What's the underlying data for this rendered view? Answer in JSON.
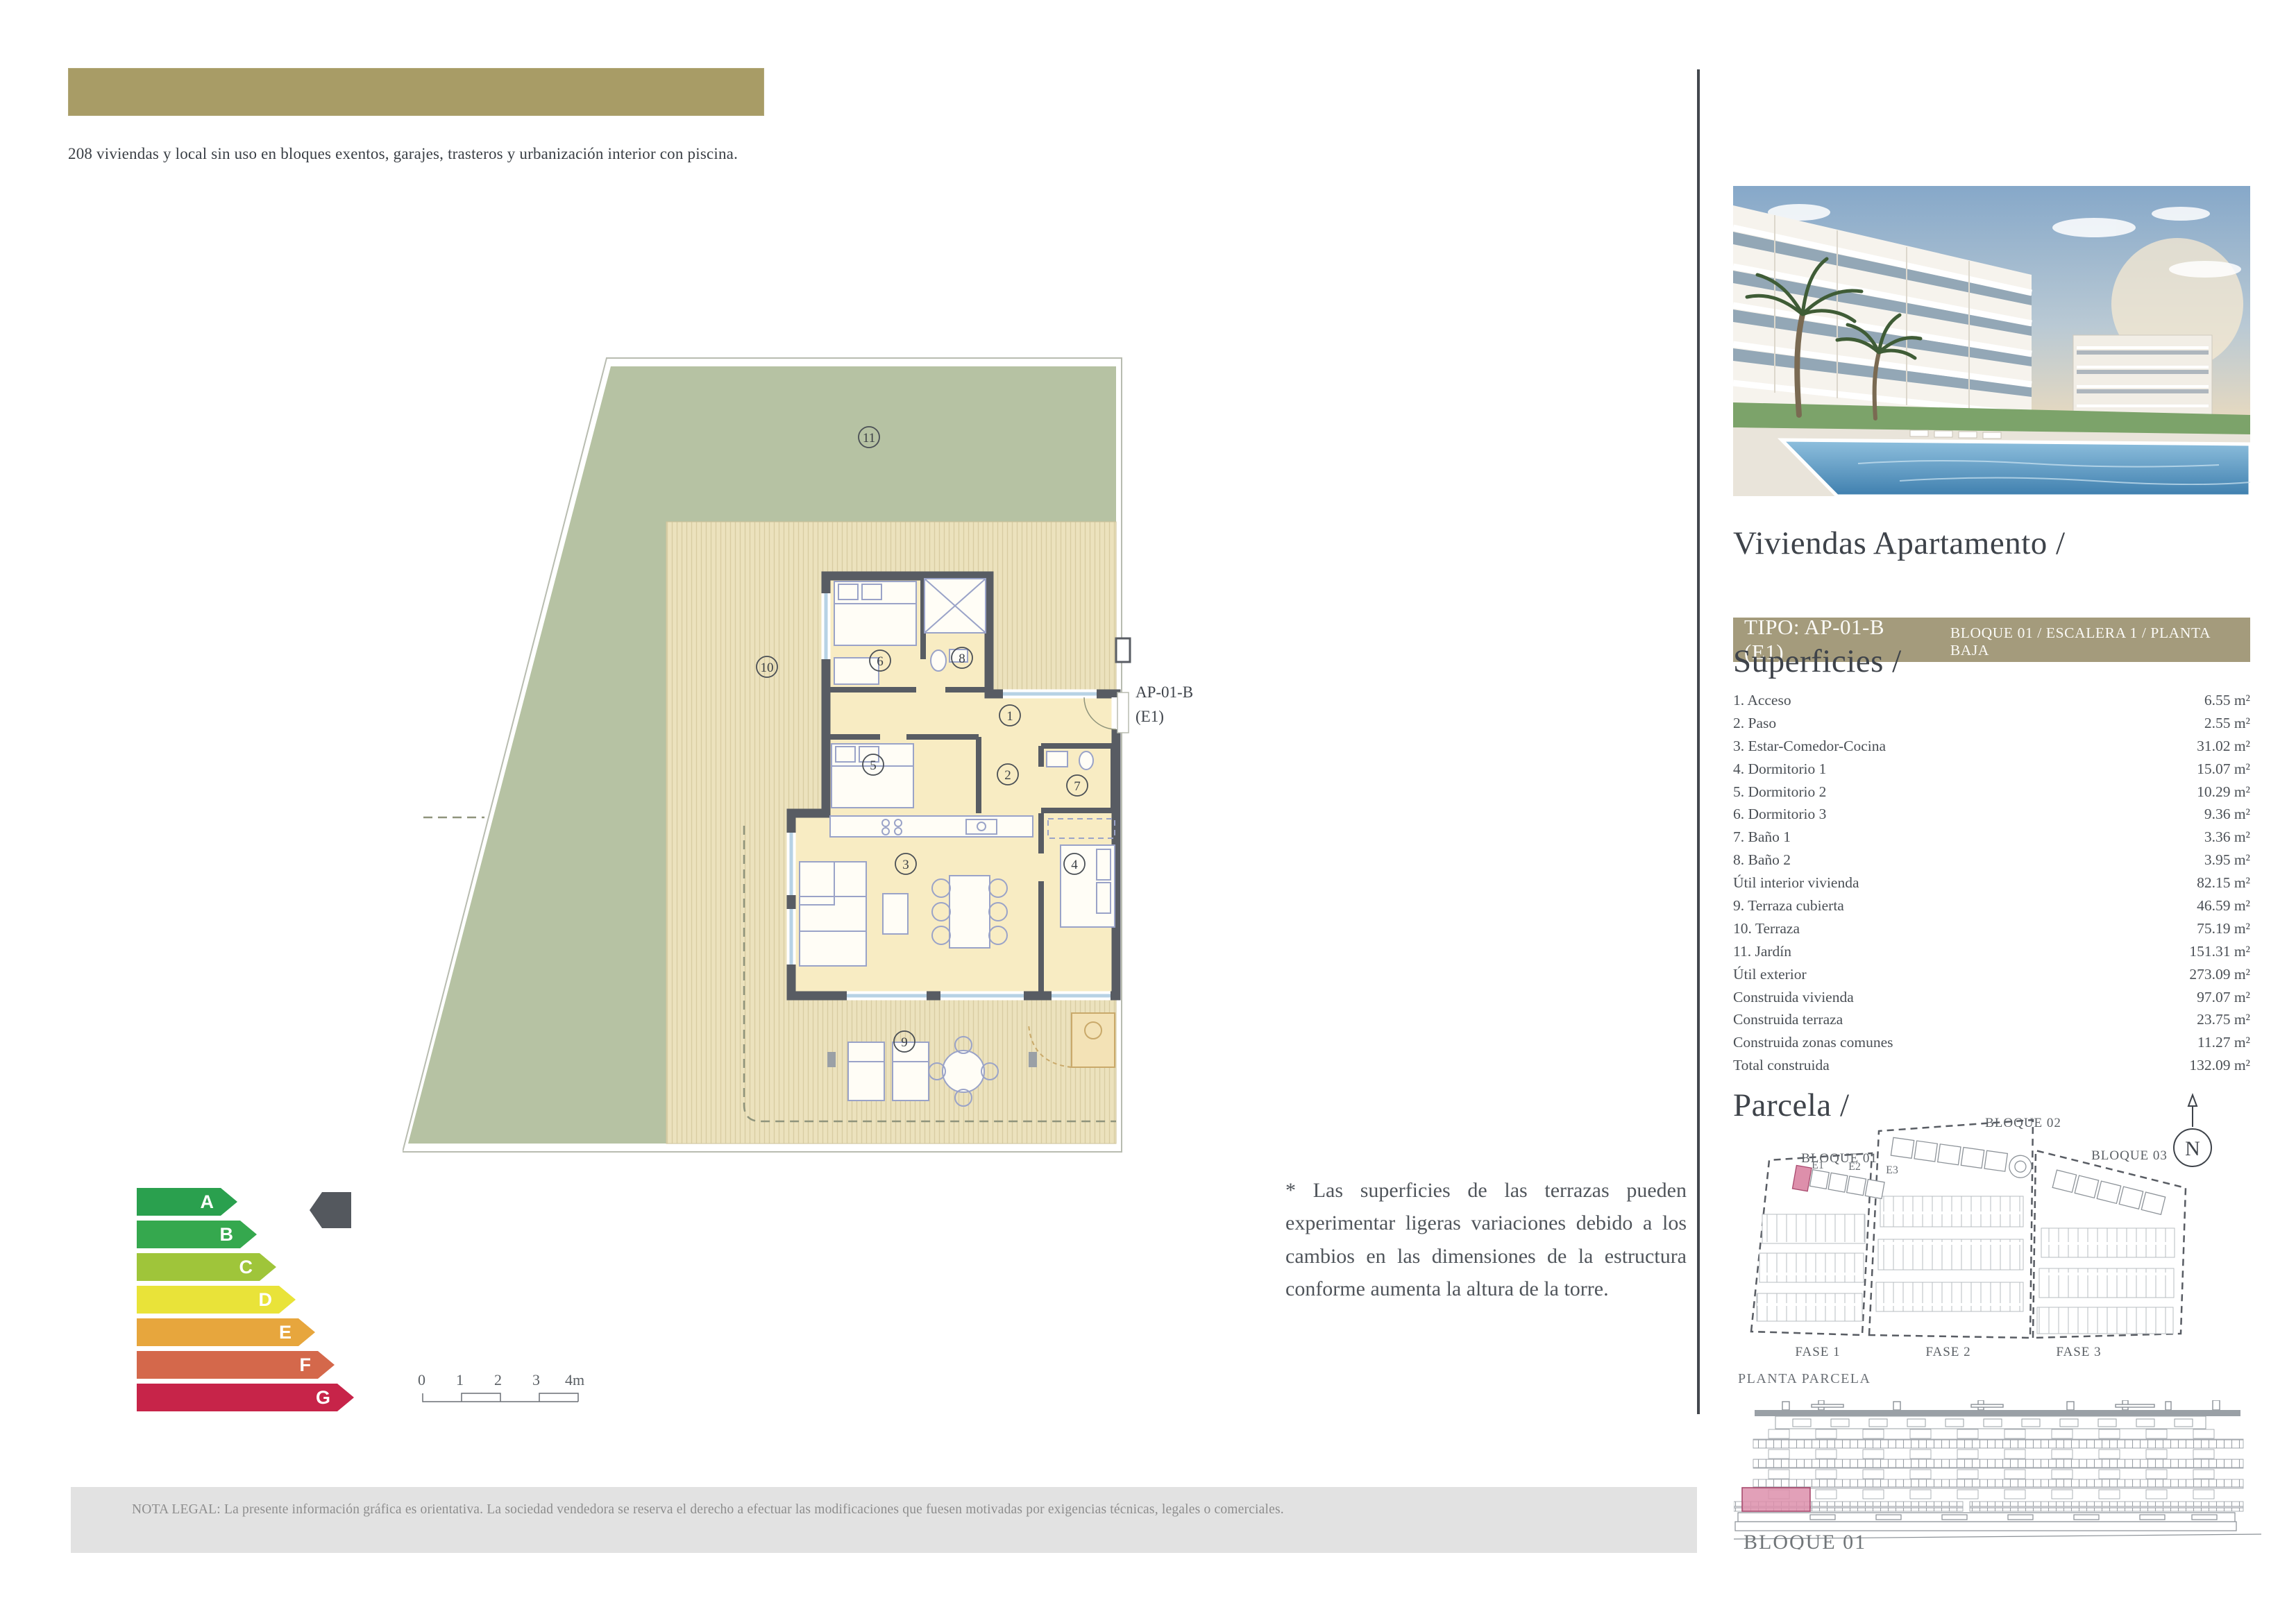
{
  "header": {
    "bar_color": "#a89c66",
    "description": "208 viviendas y local sin uso en bloques exentos, garajes, trasteros y urbanización interior con piscina."
  },
  "plan": {
    "unit_code": "AP-01-B",
    "unit_stair": "(E1)",
    "rooms": [
      "1",
      "2",
      "3",
      "4",
      "5",
      "6",
      "7",
      "8",
      "9",
      "10",
      "11"
    ],
    "colors": {
      "garden": "#b6c2a3",
      "terrace": "#ece2bd",
      "room": "#f8ecc3",
      "wall": "#585c63"
    }
  },
  "note": "* Las superficies de las terrazas pueden experimentar ligeras variaciones debido a los cambios en las dimensiones de la estructura conforme aumenta la altura de la torre.",
  "energy": {
    "grades": [
      {
        "letter": "A",
        "color": "#2aa04e"
      },
      {
        "letter": "B",
        "color": "#35a84e"
      },
      {
        "letter": "C",
        "color": "#9fc53a"
      },
      {
        "letter": "D",
        "color": "#e9e339"
      },
      {
        "letter": "E",
        "color": "#e7a63d"
      },
      {
        "letter": "F",
        "color": "#d4684b"
      },
      {
        "letter": "G",
        "color": "#c72449"
      }
    ],
    "indicator_color": "#54585e"
  },
  "scale_bar": {
    "labels": [
      "0",
      "1",
      "2",
      "3",
      "4m"
    ]
  },
  "legal": "NOTA LEGAL: La presente información gráfica es orientativa. La sociedad vendedora se reserva el derecho a efectuar las modificaciones que fuesen motivadas por exigencias técnicas, legales o comerciales.",
  "sidebar": {
    "title": "Viviendas Apartamento /",
    "tipo_label": "TIPO: AP-01-B (E1)",
    "tipo_details": "BLOQUE 01  / ESCALERA 1  / PLANTA BAJA",
    "tipo_bar_color": "#a49b7c",
    "superficies_heading": "Superficies /",
    "superficies": [
      {
        "label": "1. Acceso",
        "value": "6.55 m²"
      },
      {
        "label": "2. Paso",
        "value": "2.55 m²"
      },
      {
        "label": "3. Estar-Comedor-Cocina",
        "value": "31.02 m²"
      },
      {
        "label": "4. Dormitorio 1",
        "value": "15.07 m²"
      },
      {
        "label": "5. Dormitorio 2",
        "value": "10.29 m²"
      },
      {
        "label": "6. Dormitorio 3",
        "value": "9.36 m²"
      },
      {
        "label": "7. Baño 1",
        "value": "3.36 m²"
      },
      {
        "label": "8. Baño 2",
        "value": "3.95 m²"
      },
      {
        "label": "Útil interior vivienda",
        "value": "82.15 m²"
      },
      {
        "label": "9. Terraza cubierta",
        "value": "46.59 m²"
      },
      {
        "label": "10. Terraza",
        "value": "75.19 m²"
      },
      {
        "label": "11. Jardín",
        "value": "151.31 m²"
      },
      {
        "label": "Útil exterior",
        "value": "273.09 m²"
      },
      {
        "label": "Construida vivienda",
        "value": "97.07 m²"
      },
      {
        "label": "Construida terraza",
        "value": "23.75 m²"
      },
      {
        "label": "Construida zonas comunes",
        "value": "11.27 m²"
      },
      {
        "label": "Total construida",
        "value": "132.09 m²"
      }
    ],
    "parcela_heading": "Parcela /",
    "site_plan": {
      "compass": "N",
      "bloque_01": "BLOQUE 01",
      "bloque_02": "BLOQUE 02",
      "bloque_03": "BLOQUE 03",
      "e1": "E1",
      "e2": "E2",
      "e3": "E3",
      "fase_1": "FASE 1",
      "fase_2": "FASE 2",
      "fase_3": "FASE 3",
      "caption": "PLANTA PARCELA",
      "highlight_color": "#dd8fab"
    },
    "elevation_caption": "BLOQUE 01"
  }
}
